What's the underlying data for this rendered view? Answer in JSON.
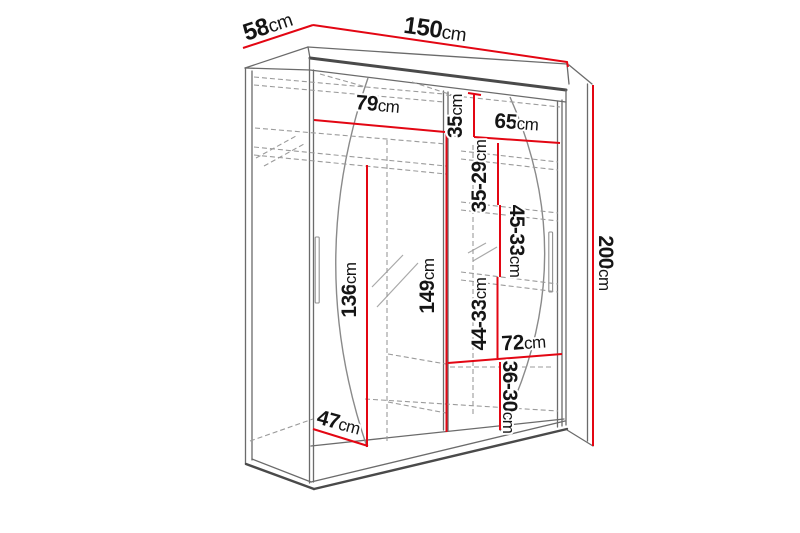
{
  "diagram": {
    "type": "furniture-dimension-diagram",
    "subject": "sliding-door-wardrobe",
    "unit": "cm",
    "colors": {
      "dimension_line": "#e30613",
      "outline": "#4a4a4a",
      "dashed_line": "#9b9b9b",
      "label_text": "#151515",
      "background": "#ffffff"
    },
    "dims": [
      {
        "id": "top-depth",
        "value": "58",
        "unit": "cm"
      },
      {
        "id": "top-width",
        "value": "150",
        "unit": "cm"
      },
      {
        "id": "inner-width-left",
        "value": "79",
        "unit": "cm"
      },
      {
        "id": "right-top-height",
        "value": "35",
        "unit": "cm"
      },
      {
        "id": "inner-width-right",
        "value": "65",
        "unit": "cm"
      },
      {
        "id": "right-gap-1",
        "value": "35-29",
        "unit": "cm"
      },
      {
        "id": "right-gap-2",
        "value": "45-33",
        "unit": "cm"
      },
      {
        "id": "left-inner-height",
        "value": "136",
        "unit": "cm"
      },
      {
        "id": "middle-inner-height",
        "value": "149",
        "unit": "cm"
      },
      {
        "id": "right-gap-3",
        "value": "44-33",
        "unit": "cm"
      },
      {
        "id": "bottom-width-right",
        "value": "72",
        "unit": "cm"
      },
      {
        "id": "right-gap-4",
        "value": "36-30",
        "unit": "cm"
      },
      {
        "id": "bottom-inner-depth",
        "value": "47",
        "unit": "cm"
      },
      {
        "id": "total-height",
        "value": "200",
        "unit": "cm"
      }
    ]
  }
}
